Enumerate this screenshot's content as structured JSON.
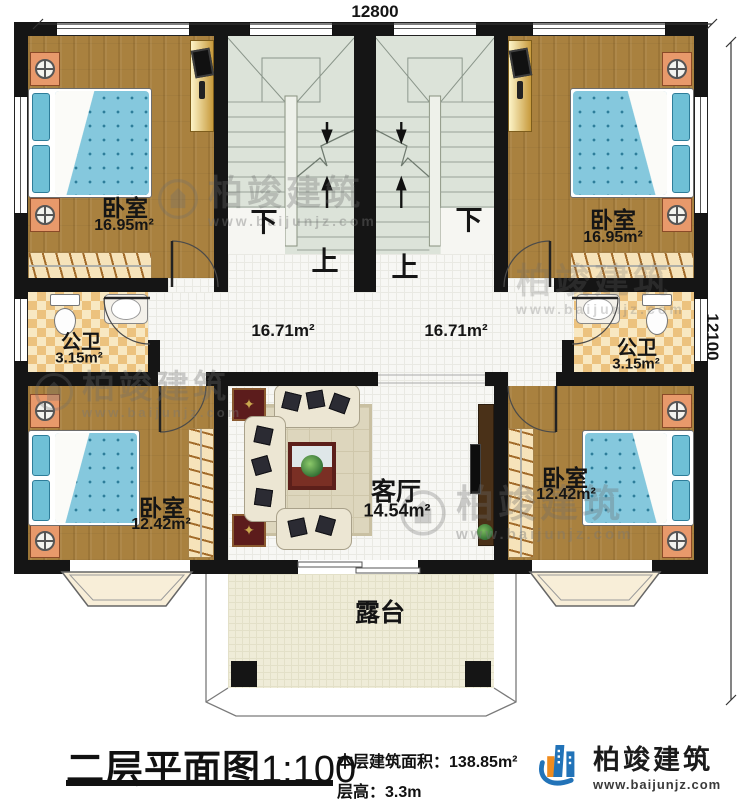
{
  "dimensions": {
    "top": "12800",
    "right": "12100"
  },
  "rooms": {
    "bedroom_tl": {
      "name": "卧室",
      "area": "16.95m²"
    },
    "bedroom_tr": {
      "name": "卧室",
      "area": "16.95m²"
    },
    "bedroom_bl": {
      "name": "卧室",
      "area": "12.42m²"
    },
    "bedroom_br": {
      "name": "卧室",
      "area": "12.42m²"
    },
    "bath_left": {
      "name": "公卫",
      "area": "3.15m²"
    },
    "bath_right": {
      "name": "公卫",
      "area": "3.15m²"
    },
    "hall_left": {
      "area": "16.71m²"
    },
    "hall_right": {
      "area": "16.71m²"
    },
    "living": {
      "name": "客厅",
      "area": "14.54m²"
    },
    "terrace": {
      "name": "露台"
    }
  },
  "stairs": {
    "down": "下",
    "up": "上"
  },
  "watermark": {
    "brand": "柏竣建筑",
    "url": "www.baijunjz.com"
  },
  "title": {
    "main": "二层平面图",
    "scale": "1:100",
    "area_label": "本层建筑面积：",
    "area_value": "138.85m²",
    "height_label": "层高：",
    "height_value": "3.3m"
  },
  "logo": {
    "brand": "柏竣建筑",
    "url": "www.baijunjz.com"
  },
  "colors": {
    "wall": "#151515",
    "wood_floor": "#a9813f",
    "bed_blue": "#85c8dd",
    "stair_floor": "#dce3d9",
    "bath_tile": "#ecc27e",
    "terrace_floor": "#efecd8",
    "brand_blue": "#2273b8",
    "brand_orange": "#f08c1e"
  }
}
